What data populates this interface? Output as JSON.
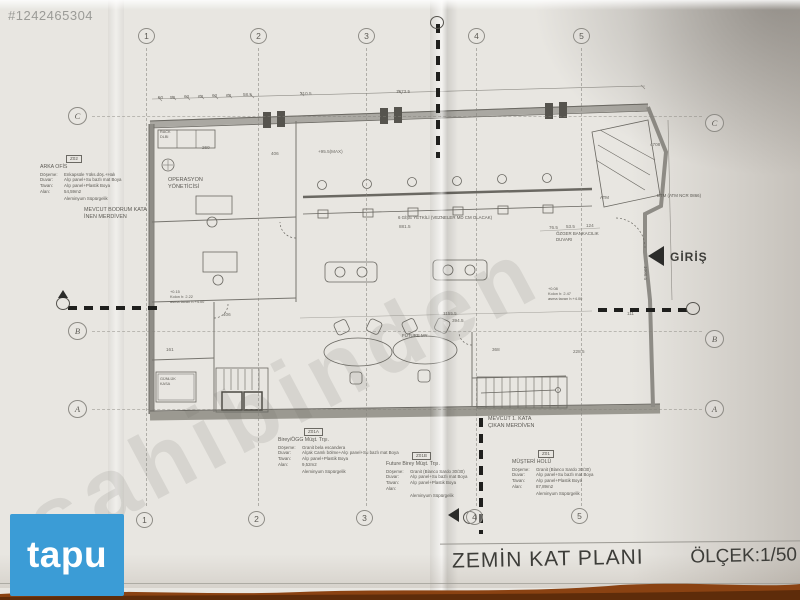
{
  "photo": {
    "listing_id": "#1242465304",
    "diagonal_watermark": "sahibinden",
    "brand_logo": "tapu"
  },
  "title_block": {
    "title": "ZEMİN KAT PLANI",
    "scale": "ÖLÇEK:1/50"
  },
  "grid": {
    "columns": [
      "1",
      "2",
      "3",
      "4",
      "5"
    ],
    "col_x": [
      146,
      258,
      366,
      476,
      581
    ],
    "top_y": 28,
    "bottom_y": 512,
    "rows": [
      "C",
      "B",
      "A"
    ],
    "row_y_left": [
      107,
      322,
      400
    ],
    "row_y_right": [
      114,
      330,
      400
    ],
    "left_x": 68,
    "right_x": 705
  },
  "spec_blocks": [
    {
      "tag": "Z02",
      "title": "ARKA OFİS",
      "rows": [
        [
          "Döşeme:",
          "Enkapsüle Yüks.döş.+Halı"
        ],
        [
          "Duvar:",
          "Alçı panel+Su bazlı mat Boya"
        ],
        [
          "Tavan:",
          "Alçı panel+Plastik Boya"
        ],
        [
          "Alan:",
          "54,59m2"
        ]
      ],
      "footer": "Aleminyum Süpürgelik",
      "x": 40,
      "y": 155,
      "w": 118
    },
    {
      "tag": "Z01A",
      "title": "Birey/ÖGG Müşt. Trşı.",
      "rows": [
        [
          "Döşeme:",
          "Granit bela escandera"
        ],
        [
          "Duvar:",
          "Alçak Camlı bölme+Alçı panel+Su bazlı mat Boya"
        ],
        [
          "Tavan:",
          "Alçı panel+Plastik Boya"
        ],
        [
          "Alan:",
          "9,52m2"
        ]
      ],
      "footer": "Aleminyum Süpürgelik",
      "x": 278,
      "y": 428,
      "w": 160
    },
    {
      "tag": "Z01B",
      "title": "Future Birey Müşt. Trşı.",
      "rows": [
        [
          "Döşeme:",
          "Granit (Blanco Sardo 30/30)"
        ],
        [
          "Duvar:",
          "Alçı panel+Su bazlı mat Boya"
        ],
        [
          "Tavan:",
          "Alçı panel+Plastik Boya"
        ],
        [
          "Alan:",
          ""
        ]
      ],
      "footer": "Aleminyum Süpürgelik",
      "x": 386,
      "y": 452,
      "w": 150
    },
    {
      "tag": "Z01",
      "title": "MÜŞTERİ HOLÜ",
      "rows": [
        [
          "Döşeme:",
          "Granit (Blanco Sardo 30/30)"
        ],
        [
          "Duvar:",
          "Alçı panel+Su bazlı mat Boya"
        ],
        [
          "Tavan:",
          "Alçı panel+Plastik Boya"
        ],
        [
          "Alan:",
          "87,89m2"
        ]
      ],
      "footer": "Aleminyum Süpürgelik",
      "x": 512,
      "y": 450,
      "w": 140
    }
  ],
  "plan_labels": [
    {
      "name": "operasyon-yoneticisi",
      "text": "OPERASYON\nYÖNETİCİSİ",
      "x": 168,
      "y": 177,
      "size": 5.5,
      "bold": false
    },
    {
      "name": "bodrum-merdiven",
      "text": "MEVCUT BODRUM KATA\nİNEN MERDİVEN",
      "x": 84,
      "y": 207,
      "size": 5.4,
      "bold": false
    },
    {
      "name": "kata-cikan-merdiven",
      "text": "MEVCUT 1. KATA\nÇIKAN MERDİVEN",
      "x": 488,
      "y": 416,
      "size": 5.4,
      "bold": false
    },
    {
      "name": "gise-yetkili",
      "text": "6 GİŞE YETKİLİ (VEZNELER MD CM OLACAK)",
      "x": 398,
      "y": 215,
      "size": 4.4,
      "bold": false
    },
    {
      "name": "bankacilik-duvari",
      "text": "ÖZGER BANKACILIK\nDUVARI",
      "x": 556,
      "y": 231,
      "size": 4.4,
      "bold": false
    },
    {
      "name": "btm-atm",
      "text": "BTM (ATM NCR 0866)",
      "x": 657,
      "y": 193,
      "size": 4.4,
      "bold": false
    },
    {
      "name": "giris",
      "text": "GİRİŞ",
      "x": 670,
      "y": 250,
      "size": 12,
      "bold": true
    },
    {
      "name": "future-my",
      "text": "FUTURE MY",
      "x": 402,
      "y": 333,
      "size": 4.4,
      "bold": false
    },
    {
      "name": "atm",
      "text": "ATM",
      "x": 600,
      "y": 195,
      "size": 4.4,
      "bold": false
    },
    {
      "name": "rack-dlbi",
      "text": "RACK\nDLBI",
      "x": 160,
      "y": 130,
      "size": 3.8,
      "bold": false
    },
    {
      "name": "kolon-note-left",
      "text": "+0.15\nKolon h: 2.22\nasma tavan h:+4.00",
      "x": 170,
      "y": 290,
      "size": 3.9,
      "bold": false
    },
    {
      "name": "kolon-note-right",
      "text": "+0.08\nKolon h: 2.47\nasma tavan h:+4.00",
      "x": 548,
      "y": 287,
      "size": 3.9,
      "bold": false
    },
    {
      "name": "gunluk-kasa",
      "text": "GÜNLÜK\nKASA",
      "x": 160,
      "y": 377,
      "size": 3.8,
      "bold": false
    }
  ],
  "dimensions": [
    {
      "text": "50",
      "x": 158,
      "y": 95
    },
    {
      "text": "50",
      "x": 170,
      "y": 95
    },
    {
      "text": "63",
      "x": 184,
      "y": 94
    },
    {
      "text": "63",
      "x": 198,
      "y": 94
    },
    {
      "text": "63",
      "x": 212,
      "y": 93
    },
    {
      "text": "63",
      "x": 226,
      "y": 93
    },
    {
      "text": "58.5",
      "x": 243,
      "y": 92
    },
    {
      "text": "310.5",
      "x": 300,
      "y": 91
    },
    {
      "text": "1673.5",
      "x": 396,
      "y": 89
    },
    {
      "text": "260",
      "x": 202,
      "y": 145
    },
    {
      "text": "406",
      "x": 271,
      "y": 151
    },
    {
      "text": "+95.5(MAX)",
      "x": 318,
      "y": 149
    },
    {
      "text": "881.5",
      "x": 399,
      "y": 224
    },
    {
      "text": "76.5",
      "x": 549,
      "y": 225
    },
    {
      "text": "53.5",
      "x": 566,
      "y": 224
    },
    {
      "text": "124",
      "x": 586,
      "y": 223
    },
    {
      "text": "1155.5",
      "x": 443,
      "y": 311
    },
    {
      "text": "394.5",
      "x": 452,
      "y": 318
    },
    {
      "text": "406",
      "x": 223,
      "y": 312
    },
    {
      "text": "161",
      "x": 166,
      "y": 347
    },
    {
      "text": "368",
      "x": 492,
      "y": 347
    },
    {
      "text": "228.5",
      "x": 573,
      "y": 349
    },
    {
      "text": "111",
      "x": 627,
      "y": 311
    },
    {
      "text": "4708",
      "x": 650,
      "y": 142
    },
    {
      "text": "1008.5",
      "x": 648,
      "y": 266,
      "rot": 90
    }
  ],
  "colors": {
    "paper": "#e8e6e1",
    "ink": "#5c5a54",
    "tapu_blue": "#3b9cd6",
    "table_wood": "#8a4212",
    "watermark_gray": "#9b9b97"
  }
}
